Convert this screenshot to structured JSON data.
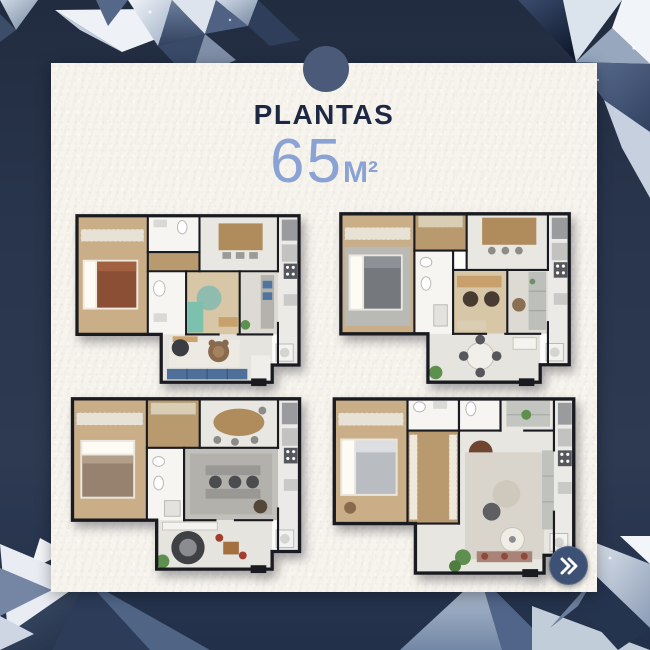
{
  "header": {
    "title": "PLANTAS",
    "area": {
      "value": "65",
      "unit": "M²"
    }
  },
  "colors": {
    "background": "#28344b",
    "band_top": "#222c40",
    "card": "#f7f4ee",
    "title": "#1d2942",
    "area_text": "#8ba3d4",
    "accent_circle": "#4a5a78",
    "next_button": "#3d5175",
    "wall": "#1a1b20"
  },
  "floor_plans": [
    {
      "id": "floorplan-top-left"
    },
    {
      "id": "floorplan-top-right"
    },
    {
      "id": "floorplan-bottom-left"
    },
    {
      "id": "floorplan-bottom-right"
    }
  ],
  "next_button": {
    "icon": "double-chevron-right"
  }
}
